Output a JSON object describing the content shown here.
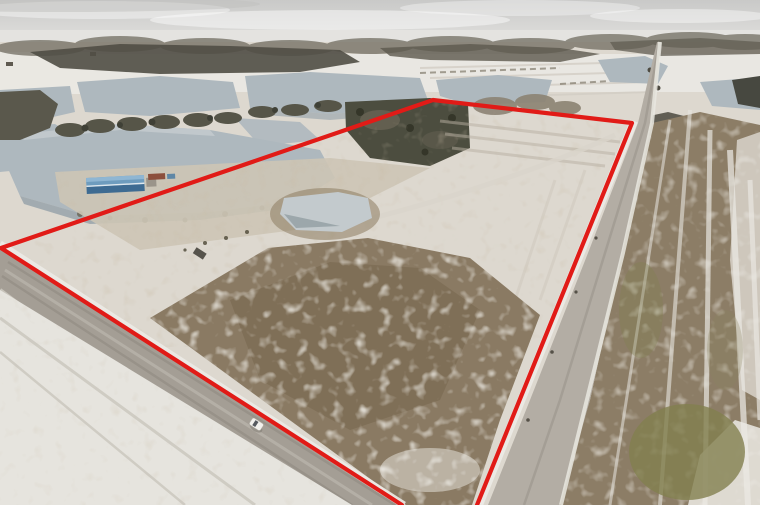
{
  "window": {
    "width": 760,
    "height": 505,
    "kind": "aerial-drone-photo"
  },
  "photo": {
    "description": "Late-winter aerial photo of a farm parcel outlined in red: snow-dusted brown field bordered by a gravel road on the left and a country road on the right, irrigation ponds and treelines behind, overcast sky",
    "sky_top": "#c9c9c8",
    "sky_horizon": "#eae9e6",
    "ground_base": "#ddd8cf",
    "water": "#aeb8be",
    "water_light": "#c3cacd",
    "snow": "#e9e7e1",
    "dirt_field": "#8a7a63",
    "dirt_dark": "#76664f",
    "road_left": "#a49e95",
    "road_right": "#b3ada4",
    "treeline": "#6d6a5f",
    "forest_dark": "#4c4d3f",
    "scrub": "#8c8373",
    "olive_patch": "#82804f",
    "barn_roof_lit": "#8fb6d3",
    "barn_side": "#3e6b92",
    "trailer_red": "#8c4f3c",
    "trailer_blue": "#5f87a6",
    "car_body": "#f2f1ed"
  },
  "annotation": {
    "name": "property-boundary",
    "color": "#e11b17",
    "stroke_width": "4.2",
    "points": "402,505 1,248 433,100 632,123 477,505"
  },
  "features": {
    "ponds": 9,
    "roads": 2,
    "vehicle": "white car on gravel road",
    "building": "long blue-roofed barn with trailers",
    "terrain": "snow-dusted plowed field, snowy pasture, distant treelines"
  }
}
